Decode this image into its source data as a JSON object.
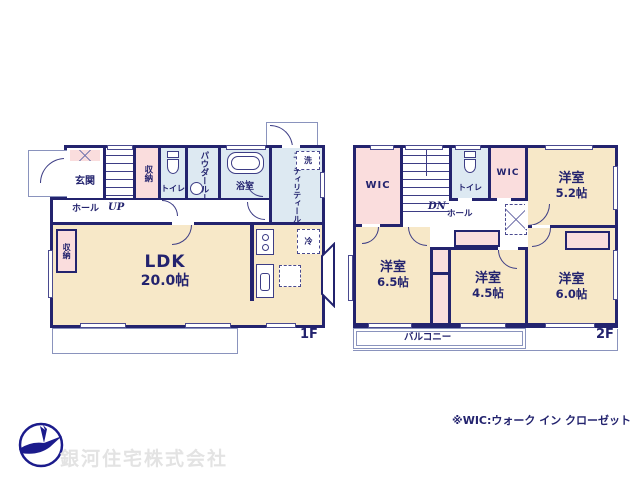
{
  "colors": {
    "wall": "#23236e",
    "cream": "#f7e8c8",
    "pink": "#fadddd",
    "blue": "#dde9f2",
    "thin": "#8a93bd",
    "line": "#3d3d85",
    "text": "#23236e",
    "company": "#e3e3e3"
  },
  "icons": {
    "logo": "swan-bird-logo"
  },
  "floor1": {
    "label": "1F",
    "genkan": "玄関",
    "hall": "ホール",
    "up": "UP",
    "storage": "収納",
    "toilet": "トイレ",
    "powder": "パウダールーム",
    "bath": "浴室",
    "utility": "ユーティリティールーム",
    "washer": "洗",
    "ldk": "LDK",
    "ldk_size": "20.0帖",
    "ldk_storage": "収納",
    "fridge": "冷"
  },
  "floor2": {
    "label": "2F",
    "wic_left": "WIC",
    "wic_top": "WIC",
    "dn": "DN",
    "hall": "ホール",
    "toilet": "トイレ",
    "balcony": "バルコニー",
    "rooms": {
      "r52": {
        "name": "洋室",
        "size": "5.2帖"
      },
      "r65": {
        "name": "洋室",
        "size": "6.5帖"
      },
      "r45": {
        "name": "洋室",
        "size": "4.5帖"
      },
      "r60": {
        "name": "洋室",
        "size": "6.0帖"
      }
    }
  },
  "footer": {
    "note": "※WIC:ウォーク イン クローゼット",
    "company": "銀河住宅株式会社"
  }
}
